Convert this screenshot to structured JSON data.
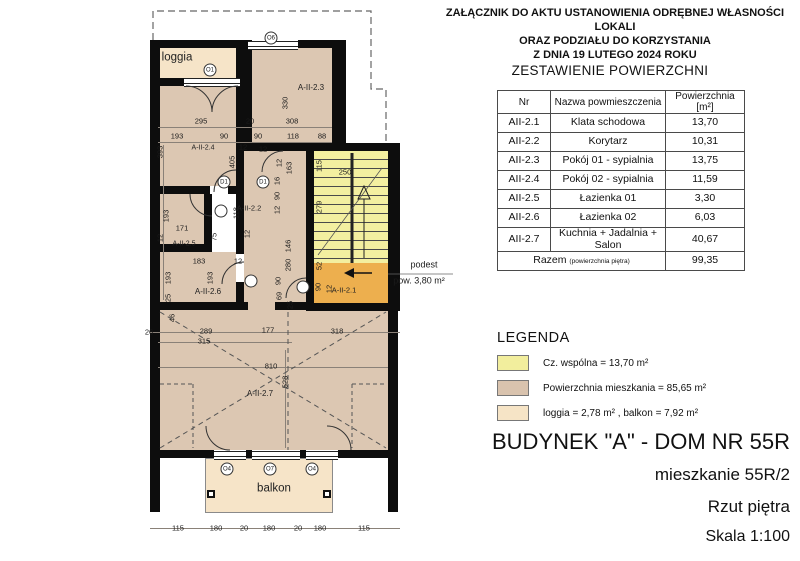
{
  "header": {
    "line1": "ZAŁĄCZNIK DO AKTU USTANOWIENIA ODRĘBNEJ WŁASNOŚCI LOKALI",
    "line2": "ORAZ PODZIAŁU DO KORZYSTANIA",
    "line3": "Z DNIA 19 LUTEGO 2024 ROKU"
  },
  "table": {
    "title": "ZESTAWIENIE POWIERZCHNI",
    "columns": [
      "Nr",
      "Nazwa powmieszczenia",
      "Powierzchnia [m²]"
    ],
    "rows": [
      [
        "AII-2.1",
        "Klata schodowa",
        "13,70"
      ],
      [
        "AII-2.2",
        "Korytarz",
        "10,31"
      ],
      [
        "AII-2.3",
        "Pokój 01 - sypialnia",
        "13,75"
      ],
      [
        "AII-2.4",
        "Pokój 02 - sypialnia",
        "11,59"
      ],
      [
        "AII-2.5",
        "Łazienka 01",
        "3,30"
      ],
      [
        "AII-2.6",
        "Łazienka 02",
        "6,03"
      ],
      [
        "AII-2.7",
        "Kuchnia + Jadalnia + Salon",
        "40,67"
      ]
    ],
    "total_label": "Razem",
    "total_sublabel": "(powierzchnia piętra)",
    "total_value": "99,35"
  },
  "legend": {
    "title": "LEGENDA",
    "items": [
      {
        "color": "#f2ee9d",
        "label": "Cz. wspólna  = 13,70 m²"
      },
      {
        "color": "#d9c3ae",
        "label": "Powierzchnia mieszkania = 85,65 m²"
      },
      {
        "color": "#f6e4c6",
        "label": "loggia  = 2,78 m² , balkon = 7,92 m²"
      }
    ]
  },
  "titleblock": {
    "line1": "BUDYNEK \"A\" - DOM NR 55R",
    "line2": "mieszkanie 55R/2",
    "line3": "Rzut piętra",
    "line4": "Skala 1:100"
  },
  "colors": {
    "wall": "#0d0d0d",
    "room": "#dcc7b2",
    "loggia": "#f6e4c8",
    "stair": "#f3efa0",
    "podest": "#edaf4e"
  },
  "plan": {
    "note": {
      "line1": "podest",
      "line2": "pow. 3,80 m²"
    },
    "annotations": [
      {
        "t": "loggia",
        "x": 177,
        "y": 58,
        "c": "big-lbl",
        "n": "room-label-loggia"
      },
      {
        "t": "balkon",
        "x": 274,
        "y": 489,
        "c": "big-lbl",
        "n": "room-label-balkon"
      },
      {
        "t": "A-II-2.3",
        "x": 311,
        "y": 88,
        "c": "room-lbl",
        "n": "room-label-a-ii-2-3"
      },
      {
        "t": "A-II-2.4",
        "x": 203,
        "y": 148,
        "c": "room-lbl",
        "s": 7,
        "n": "room-label-a-ii-2-4"
      },
      {
        "t": "A-II-2.2",
        "x": 249,
        "y": 208,
        "c": "room-lbl",
        "s": 7.5,
        "n": "room-label-a-ii-2-2"
      },
      {
        "t": "A-II-2.5",
        "x": 184,
        "y": 244,
        "c": "room-lbl",
        "s": 7,
        "n": "room-label-a-ii-2-5"
      },
      {
        "t": "A-II-2.6",
        "x": 208,
        "y": 292,
        "c": "room-lbl",
        "n": "room-label-a-ii-2-6"
      },
      {
        "t": "A-II-2.1",
        "x": 344,
        "y": 290,
        "c": "room-lbl",
        "s": 7.5,
        "n": "room-label-a-ii-2-1"
      },
      {
        "t": "A-II-2.7",
        "x": 260,
        "y": 394,
        "c": "room-lbl",
        "n": "room-label-a-ii-2-7"
      },
      {
        "t": "podest",
        "x": 424,
        "y": 265,
        "s": 9,
        "n": "podest-note"
      },
      {
        "t": "pow. 3,80 m²",
        "x": 419,
        "y": 281,
        "s": 9,
        "n": "podest-area-note"
      },
      {
        "t": "295",
        "x": 201,
        "y": 121
      },
      {
        "t": "20",
        "x": 250,
        "y": 121
      },
      {
        "t": "308",
        "x": 292,
        "y": 121
      },
      {
        "t": "193",
        "x": 177,
        "y": 136
      },
      {
        "t": "90",
        "x": 224,
        "y": 136
      },
      {
        "t": "12",
        "x": 243,
        "y": 147
      },
      {
        "t": "90",
        "x": 258,
        "y": 136
      },
      {
        "t": "12",
        "x": 263,
        "y": 149
      },
      {
        "t": "118",
        "x": 293,
        "y": 136
      },
      {
        "t": "88",
        "x": 322,
        "y": 136
      },
      {
        "t": "330",
        "x": 285,
        "y": 103,
        "r": -90
      },
      {
        "t": "393",
        "x": 160,
        "y": 152,
        "r": -90
      },
      {
        "t": "405",
        "x": 232,
        "y": 162,
        "r": -90
      },
      {
        "t": "163",
        "x": 289,
        "y": 168,
        "r": -90
      },
      {
        "t": "12",
        "x": 279,
        "y": 163,
        "r": -90
      },
      {
        "t": "115",
        "x": 319,
        "y": 166,
        "r": -90
      },
      {
        "t": "250",
        "x": 345,
        "y": 172
      },
      {
        "t": "279",
        "x": 319,
        "y": 207,
        "r": -90
      },
      {
        "t": "118",
        "x": 236,
        "y": 213,
        "r": -90
      },
      {
        "t": "171",
        "x": 182,
        "y": 228
      },
      {
        "t": "193",
        "x": 166,
        "y": 216,
        "r": -90
      },
      {
        "t": "12",
        "x": 160,
        "y": 238,
        "r": -90
      },
      {
        "t": "75",
        "x": 214,
        "y": 237,
        "r": -90
      },
      {
        "t": "12",
        "x": 247,
        "y": 234,
        "r": -90
      },
      {
        "t": "16",
        "x": 277,
        "y": 181,
        "r": -90
      },
      {
        "t": "90",
        "x": 277,
        "y": 196,
        "r": -90
      },
      {
        "t": "12",
        "x": 277,
        "y": 210,
        "r": -90
      },
      {
        "t": "183",
        "x": 199,
        "y": 261
      },
      {
        "t": "12",
        "x": 238,
        "y": 261
      },
      {
        "t": "193",
        "x": 168,
        "y": 278,
        "r": -90
      },
      {
        "t": "193",
        "x": 210,
        "y": 278,
        "r": -90
      },
      {
        "t": "25",
        "x": 168,
        "y": 298,
        "r": -90
      },
      {
        "t": "146",
        "x": 288,
        "y": 246,
        "r": -90
      },
      {
        "t": "280",
        "x": 288,
        "y": 265,
        "r": -90
      },
      {
        "t": "90",
        "x": 278,
        "y": 281,
        "r": -90
      },
      {
        "t": "69",
        "x": 279,
        "y": 296,
        "r": -90
      },
      {
        "t": "25",
        "x": 290,
        "y": 305,
        "r": -90
      },
      {
        "t": "52",
        "x": 319,
        "y": 266,
        "r": -90
      },
      {
        "t": "90",
        "x": 318,
        "y": 287,
        "r": -90
      },
      {
        "t": "12",
        "x": 329,
        "y": 289,
        "r": -90
      },
      {
        "t": "46",
        "x": 172,
        "y": 318,
        "r": -90
      },
      {
        "t": "26",
        "x": 149,
        "y": 332
      },
      {
        "t": "289",
        "x": 206,
        "y": 331
      },
      {
        "t": "177",
        "x": 268,
        "y": 330
      },
      {
        "t": "318",
        "x": 337,
        "y": 331
      },
      {
        "t": "315",
        "x": 204,
        "y": 341
      },
      {
        "t": "810",
        "x": 271,
        "y": 366
      },
      {
        "t": "528",
        "x": 285,
        "y": 382,
        "r": -90
      },
      {
        "t": "115",
        "x": 178,
        "y": 528
      },
      {
        "t": "180",
        "x": 216,
        "y": 528
      },
      {
        "t": "20",
        "x": 244,
        "y": 528
      },
      {
        "t": "180",
        "x": 269,
        "y": 528
      },
      {
        "t": "20",
        "x": 298,
        "y": 528
      },
      {
        "t": "180",
        "x": 320,
        "y": 528
      },
      {
        "t": "115",
        "x": 364,
        "y": 528
      },
      {
        "t": "O1",
        "x": 210,
        "y": 70,
        "c": "tag",
        "n": "window-tag-o1"
      },
      {
        "t": "O6",
        "x": 271,
        "y": 38,
        "c": "tag",
        "n": "window-tag-o6"
      },
      {
        "t": "D1",
        "x": 224,
        "y": 182,
        "c": "tag",
        "n": "door-tag-d1"
      },
      {
        "t": "D1",
        "x": 263,
        "y": 182,
        "c": "tag",
        "n": "door-tag-d1"
      },
      {
        "t": "",
        "x": 221,
        "y": 211,
        "c": "tag",
        "n": "door-tag"
      },
      {
        "t": "",
        "x": 251,
        "y": 281,
        "c": "tag",
        "n": "door-tag"
      },
      {
        "t": "",
        "x": 303,
        "y": 287,
        "c": "tag",
        "n": "door-tag"
      },
      {
        "t": "O4",
        "x": 227,
        "y": 469,
        "c": "tag",
        "n": "window-tag-o4"
      },
      {
        "t": "O7",
        "x": 270,
        "y": 469,
        "c": "tag",
        "n": "window-tag-o7"
      },
      {
        "t": "O4",
        "x": 312,
        "y": 469,
        "c": "tag",
        "n": "window-tag-o4"
      }
    ]
  }
}
